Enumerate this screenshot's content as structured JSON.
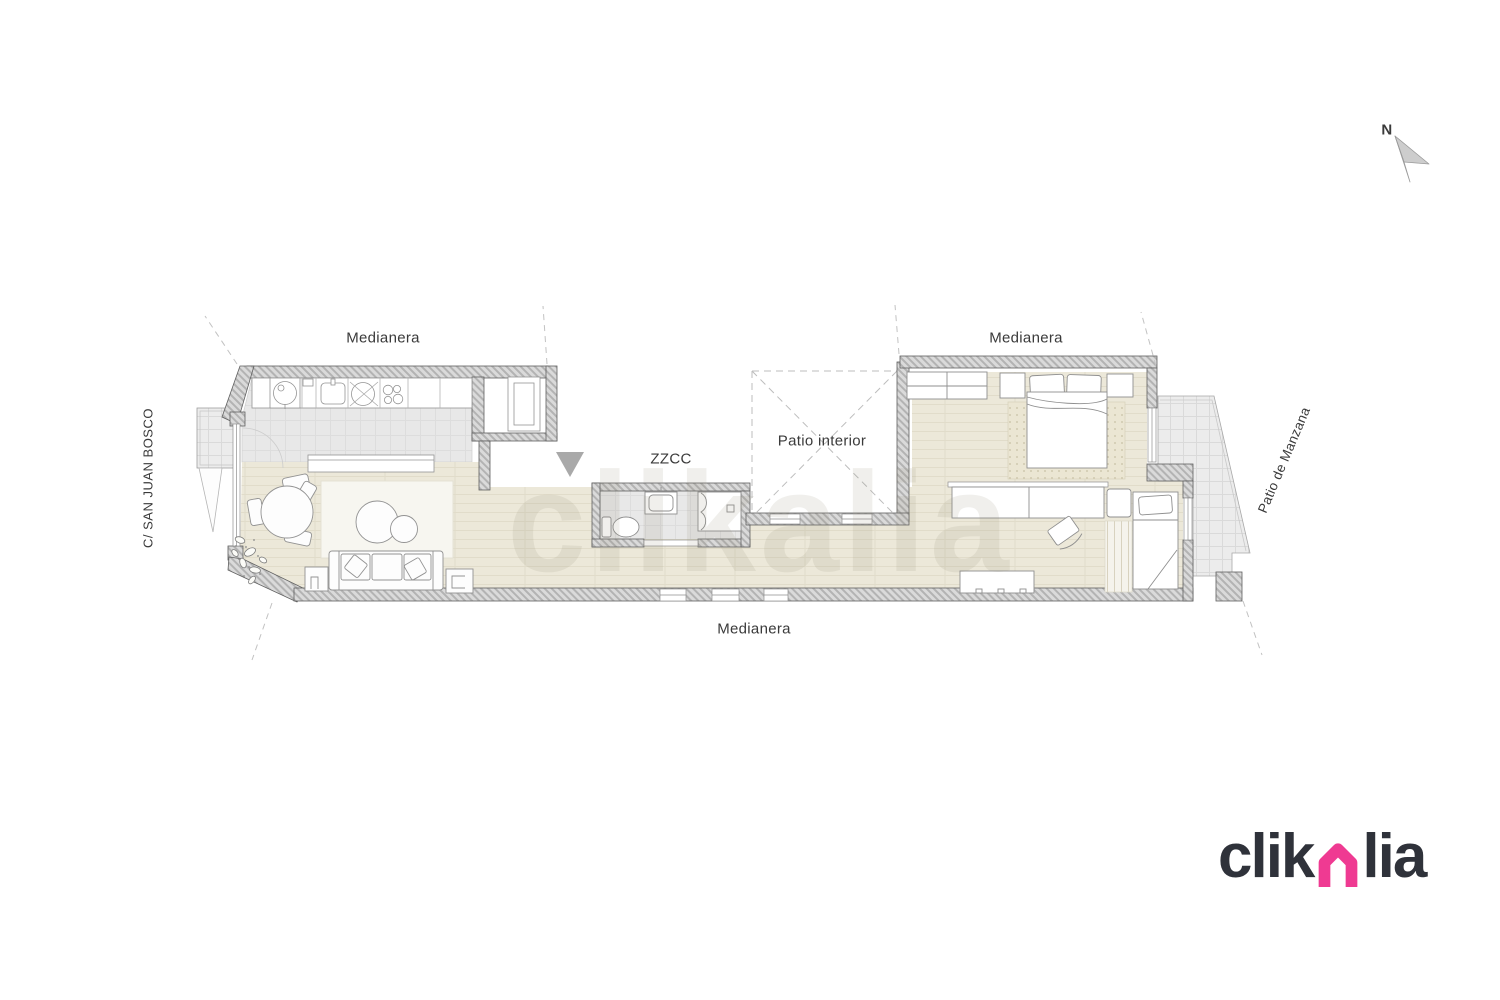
{
  "labels": {
    "medianera_top_left": "Medianera",
    "medianera_top_right": "Medianera",
    "medianera_bottom": "Medianera",
    "zzcc": "ZZCC",
    "patio_interior": "Patio interior",
    "street_left": "C/ SAN JUAN BOSCO",
    "patio_right": "Patio de Manzana",
    "compass_north": "N"
  },
  "watermark": {
    "text": "clikalia"
  },
  "logo": {
    "part1": "clik",
    "part2": "lia",
    "house_color": "#ef3a92",
    "text_color": "#2f323a"
  },
  "plan_colors": {
    "wall_hatch": "#d9d9d9",
    "wood_floor": "#ece8d9",
    "tile_floor": "#e8e8e8",
    "terrace": "#ececec",
    "entry_arrow": "#a9a9a9"
  }
}
